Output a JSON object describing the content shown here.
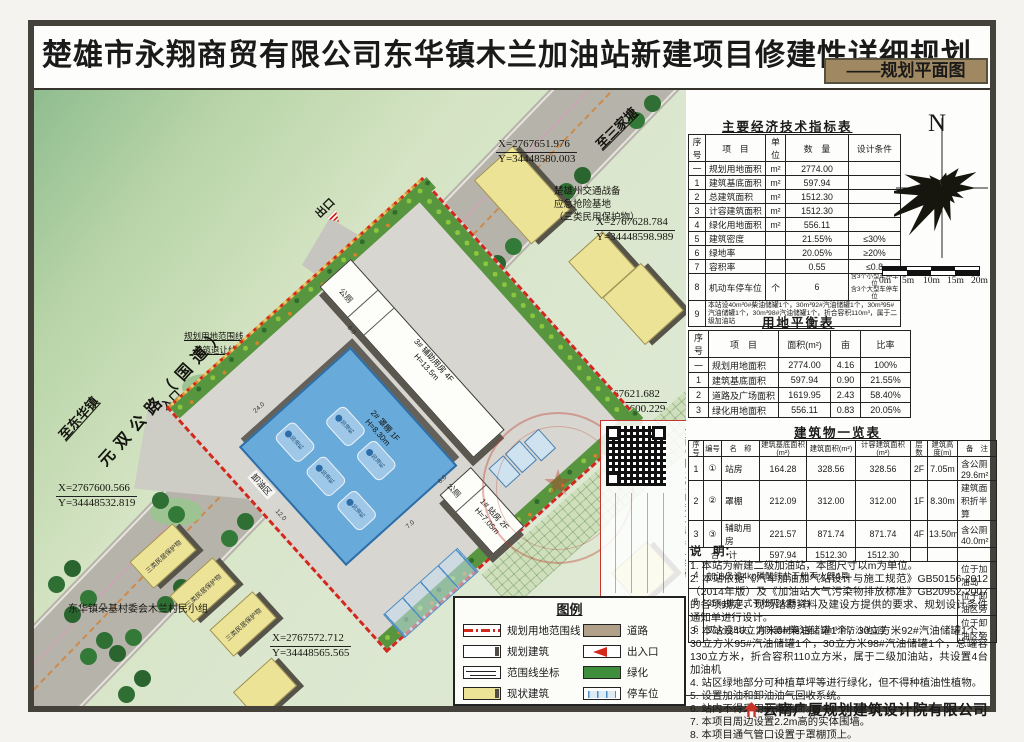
{
  "sheet": {
    "title": "楚雄市永翔商贸有限公司东华镇木兰加油站新建项目修建性详细规划",
    "subtitle": "——规划平面图",
    "company": "云南广厦规划建筑设计院有限公司"
  },
  "compass": {
    "north": "N"
  },
  "scalebar": {
    "labels": [
      "0m",
      "5m",
      "10m",
      "15m",
      "20m"
    ]
  },
  "indicators_table": {
    "title": "主要经济技术指标表",
    "headers": [
      "序号",
      "项　目",
      "单位",
      "数　量",
      "设计条件"
    ],
    "rows": [
      [
        "一",
        "规划用地面积",
        "m²",
        "2774.00",
        ""
      ],
      [
        "1",
        "建筑基底面积",
        "m²",
        "597.94",
        ""
      ],
      [
        "2",
        "总建筑面积",
        "m²",
        "1512.30",
        ""
      ],
      [
        "3",
        "计容建筑面积",
        "m²",
        "1512.30",
        ""
      ],
      [
        "4",
        "绿化用地面积",
        "m²",
        "556.11",
        ""
      ],
      [
        "5",
        "建筑密度",
        "",
        "21.55%",
        "≤30%"
      ],
      [
        "6",
        "绿地率",
        "",
        "20.05%",
        "≥20%"
      ],
      [
        "7",
        "容积率",
        "",
        "0.55",
        "≤0.8"
      ]
    ],
    "parking_row": {
      "no": "8",
      "item": "机动车停车位",
      "unit": "个",
      "qty": "6",
      "cond1": "含3个小型车停车位",
      "cond2": "含3个大型车停车位"
    },
    "tank_row": {
      "no": "9",
      "text": "本站设40m³0#柴油储罐1个，30m³92#汽油储罐1个，30m³95#汽油储罐1个，30m³98#汽油储罐1个，折合容积110m³，属于二级加油站"
    }
  },
  "land_table": {
    "title": "用地平衡表",
    "headers": [
      "序号",
      "项　目",
      "面积(m²)",
      "亩",
      "比率"
    ],
    "rows": [
      [
        "一",
        "规划用地面积",
        "2774.00",
        "4.16",
        "100%"
      ],
      [
        "1",
        "建筑基底面积",
        "597.94",
        "0.90",
        "21.55%"
      ],
      [
        "2",
        "道路及广场面积",
        "1619.95",
        "2.43",
        "58.40%"
      ],
      [
        "3",
        "绿化用地面积",
        "556.11",
        "0.83",
        "20.05%"
      ]
    ]
  },
  "building_table": {
    "title": "建筑物一览表",
    "headers": [
      "序号",
      "编号",
      "名　称",
      "建筑基底面积(m²)",
      "建筑面积(m²)",
      "计容建筑面积(m²)",
      "层数",
      "建筑高度(m)",
      "备　注"
    ],
    "rows": [
      [
        "1",
        "①",
        "站房",
        "164.28",
        "328.56",
        "328.56",
        "2F",
        "7.05m",
        "含公厕29.6m²"
      ],
      [
        "2",
        "②",
        "罩棚",
        "212.09",
        "312.00",
        "312.00",
        "1F",
        "8.30m",
        "建筑面积折半算"
      ],
      [
        "3",
        "③",
        "辅助用房",
        "221.57",
        "871.74",
        "871.74",
        "4F",
        "13.50m",
        "含公厕40.0m²"
      ]
    ],
    "total_row": {
      "label": "合　计",
      "base": "597.94",
      "area": "1512.30",
      "capacity": "1512.30"
    },
    "extra_rows": [
      {
        "no": "4",
        "text": "加油岛设4kg磷酸铵盐干粉灭火器4具",
        "loc": "位于加油岛"
      },
      {
        "no": "5",
        "text": "35kg推车式干粉灭火器1台",
        "loc": "位于卸油区旁"
      },
      {
        "no": "6",
        "text": "灭火毯5块、消防器材箱1座、2m³消防沙池1座",
        "loc": "位于卸油区旁"
      }
    ]
  },
  "notes": {
    "title": "说　明：",
    "items": [
      "1. 本站为新建二级加油站，本图尺寸以m为单位。",
      "2. 本站依据《汽车加油加气站设计与施工规范》GB50156-2012（2014年版）及《加油站大气污染物排放标准》GB20952-2007的各项规定、现场踏勘资料及建设方提供的要求、规划设计条件通知单进行设计。",
      "3. 本站设40立方米0#柴油储罐1个，30立方米92#汽油储罐1个，30立方米95#汽油储罐1个，30立方米98#汽油储罐1个，总罐容130立方米，折合容积110立方米，属于二级加油站，共设置4台加油机",
      "4. 站区绿地部分可种植草坪等进行绿化，但不得种植油性植物。",
      "5. 设置加油和卸油油气回收系统。",
      "6. 站内不得采用沥青路面。",
      "7. 本项目周边设置2.2m高的实体围墙。",
      "8. 本项目通气管口设置于罩棚顶上。"
    ]
  },
  "legend": {
    "title": "图例",
    "left": [
      "规划用地范围线",
      "规划建筑",
      "范围线坐标",
      "现状建筑"
    ],
    "right": [
      "道路",
      "出入口",
      "绿化",
      "停车位"
    ]
  },
  "map": {
    "road_label": "元双公路（国道）",
    "dir_ne": "至三家塘",
    "dir_sw": "至东华镇",
    "exit_label": "出口",
    "entrance_label": "入口",
    "boundary_label": "规划用地范围线",
    "setback_label": "建筑退让线",
    "base_label_1": "楚雄州交通战备",
    "base_label_2": "应急抢险基地",
    "base_label_3": "（三类民用保护物）",
    "village_label": "东华镇朵基村委会木兰村民小组",
    "protected_label": "三类民居保护物",
    "unload_label": "卸油区",
    "toilet_label": "公厕",
    "canopy_label_1": "2# 罩棚 1F",
    "canopy_label_2": "H=8.30m",
    "aux_label_1": "3# 辅助用房 4F",
    "aux_label_2": "H=13.5m",
    "station_label_1": "1# 站房 2F",
    "station_label_2": "H=7.05m",
    "pump_label": "加油机",
    "qr_caption": "云南省国土空间规划成果二维码",
    "coords": [
      {
        "x": "X=2767651.976",
        "y": "Y=34448580.003"
      },
      {
        "x": "X=2767628.784",
        "y": "Y=34448598.989"
      },
      {
        "x": "X=2767621.682",
        "y": "Y=34448600.229"
      },
      {
        "x": "X=2767600.566",
        "y": "Y=34448532.819"
      },
      {
        "x": "X=2767572.712",
        "y": "Y=34448565.565"
      }
    ],
    "dims": [
      "24.0",
      "12.0",
      "8.0",
      "6.0",
      "7.0"
    ]
  }
}
